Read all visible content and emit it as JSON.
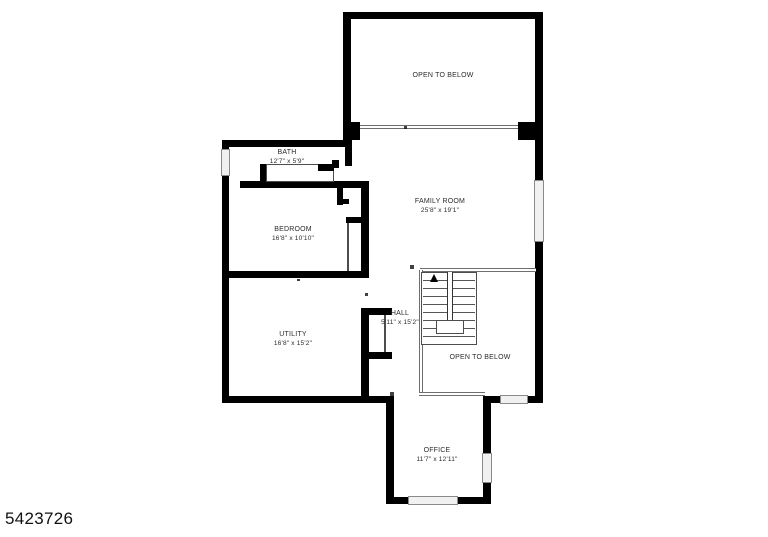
{
  "listing": {
    "id": "5423726"
  },
  "colors": {
    "wall": "#000000",
    "thin_line": "#4d4d4d",
    "window_fill": "#f1f1f1",
    "label_text": "#2b2b2b",
    "background": "#ffffff"
  },
  "rooms": {
    "open_below_top": {
      "label": "OPEN TO BELOW"
    },
    "bath": {
      "label": "BATH",
      "dims": "12'7\" x 5'9\""
    },
    "family_room": {
      "label": "FAMILY ROOM",
      "dims": "25'8\" x 19'1\""
    },
    "bedroom": {
      "label": "BEDROOM",
      "dims": "16'8\" x 10'10\""
    },
    "utility": {
      "label": "UTILITY",
      "dims": "16'8\" x 15'2\""
    },
    "hall": {
      "label": "HALL",
      "dims": "5'11\" x 15'2\""
    },
    "open_below_lower": {
      "label": "OPEN TO BELOW"
    },
    "office": {
      "label": "OFFICE",
      "dims": "11'7\" x 12'11\""
    }
  }
}
